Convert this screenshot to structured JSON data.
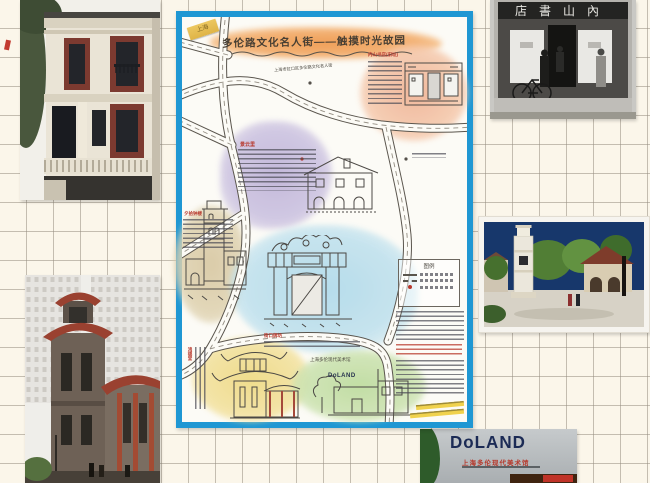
{
  "map": {
    "sticker_label": "上海",
    "title": "多伦路文化名人街——触摸时光故园",
    "district_label": "上海市虹口区多伦路文化名人街",
    "sites": {
      "jingyunli": "景云里",
      "bookstore": "内山书店(旧址)",
      "bell_tower": "夕拾钟楼",
      "archway": "街口牌坊",
      "hongde_hall": "鸿德堂",
      "museum_name": "上海多伦现代美术馆",
      "museum_logo": "DoLAND"
    },
    "legend_title": "图例"
  },
  "photos": {
    "bookstore_sign": "店書山內",
    "museum_wall": {
      "logo": "DoLAND",
      "name_cn": "上海多伦现代美术馆"
    }
  },
  "colors": {
    "frame_blue": "#1f97d3",
    "paper": "#fbf6ea",
    "grid_line": "#b8b1a4"
  }
}
